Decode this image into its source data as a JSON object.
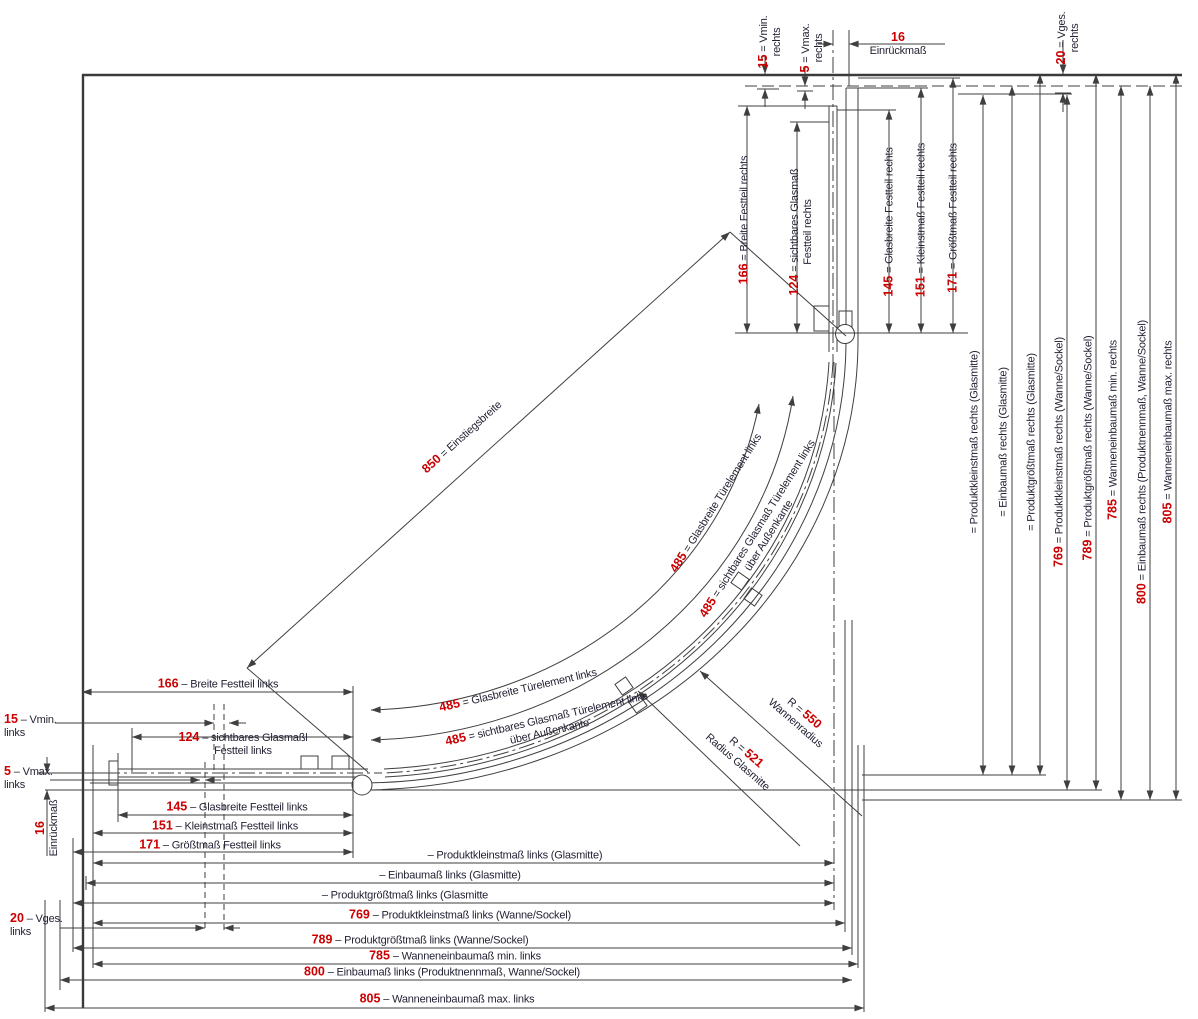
{
  "colors": {
    "dimension_number": "#cc0000",
    "label_text": "#232335",
    "line": "#3f3f3f",
    "background": "#ffffff"
  },
  "drawing_type": "Maßzeichnung Runddusche (Draufsicht)",
  "dimensions": [
    {
      "name": "dim-vmin-rechts",
      "num": "15",
      "text": "= Vmin.",
      "text2": "rechts",
      "x": 770,
      "y": 42,
      "rot": -90
    },
    {
      "name": "dim-vmax-rechts",
      "num": "5",
      "text": "= Vmax.",
      "text2": "rechts",
      "x": 812,
      "y": 48,
      "rot": -90
    },
    {
      "name": "dim-einrueckmass-rechts",
      "num": "16",
      "text": "",
      "text2": "Einrückmaß",
      "x": 898,
      "y": 44,
      "rot": 0
    },
    {
      "name": "dim-vges-rechts",
      "num": "20",
      "text": "= Vges.",
      "text2": "rechts",
      "x": 1068,
      "y": 38,
      "rot": -90
    },
    {
      "name": "dim-breite-festteil-rechts",
      "num": "166",
      "text": "= Breite Festteil rechts",
      "text2": "",
      "x": 744,
      "y": 220,
      "rot": -90
    },
    {
      "name": "dim-sichtbares-glasmass-festteil-rechts",
      "num": "124",
      "text": "= sichtbares Glasmaß",
      "text2": "Festteil rechts",
      "x": 801,
      "y": 232,
      "rot": -90
    },
    {
      "name": "dim-glasbreite-festteil-rechts",
      "num": "145",
      "text": "= Glasbreite Festteil rechts",
      "text2": "",
      "x": 889,
      "y": 222,
      "rot": -90
    },
    {
      "name": "dim-kleinstmass-festteil-rechts",
      "num": "151",
      "text": "= Kleinstmaß Festteil rechts",
      "text2": "",
      "x": 921,
      "y": 220,
      "rot": -90
    },
    {
      "name": "dim-groesstmass-festteil-rechts",
      "num": "171",
      "text": "= Größtmaß Festteil rechts",
      "text2": "",
      "x": 953,
      "y": 218,
      "rot": -90
    },
    {
      "name": "dim-produktkleinstmass-rechts-glasmitte",
      "num": "",
      "text": "= Produktkleinstmaß rechts (Glasmitte)",
      "text2": "",
      "x": 975,
      "y": 442,
      "rot": -90
    },
    {
      "name": "dim-einbaumass-rechts-glasmitte",
      "num": "",
      "text": "= Einbaumaß rechts (Glasmitte)",
      "text2": "",
      "x": 1004,
      "y": 442,
      "rot": -90
    },
    {
      "name": "dim-produktgroesstmass-rechts-glasmitte",
      "num": "",
      "text": "= Produktgrößtmaß rechts (Glasmitte)",
      "text2": "",
      "x": 1032,
      "y": 442,
      "rot": -90
    },
    {
      "name": "dim-produktkleinstmass-rechts-wanne",
      "num": "769",
      "text": "= Produktkleinstmaß rechts (Wanne/Sockel)",
      "text2": "",
      "x": 1059,
      "y": 452,
      "rot": -90
    },
    {
      "name": "dim-produktgroesstmass-rechts-wanne",
      "num": "789",
      "text": "= Produktgrößtmaß rechts (Wanne/Sockel)",
      "text2": "",
      "x": 1088,
      "y": 448,
      "rot": -90
    },
    {
      "name": "dim-wanneneinbaumass-min-rechts",
      "num": "785",
      "text": "= Wanneneinbaumaß min. rechts",
      "text2": "",
      "x": 1113,
      "y": 430,
      "rot": -90
    },
    {
      "name": "dim-einbaumass-rechts-produktnennmass",
      "num": "800",
      "text": "= Einbaumaß rechts (Produktnennmaß, Wanne/Sockel)",
      "text2": "",
      "x": 1142,
      "y": 462,
      "rot": -90
    },
    {
      "name": "dim-wanneneinbaumass-max-rechts",
      "num": "805",
      "text": "= Wanneneinbaumaß max. rechts",
      "text2": "",
      "x": 1168,
      "y": 432,
      "rot": -90
    },
    {
      "name": "dim-einstiegsbreite",
      "num": "850",
      "text": "= Einstiegsbreite",
      "text2": "",
      "x": 462,
      "y": 437,
      "rot": -42
    },
    {
      "name": "dim-glasbreite-tuerelement-links-oben",
      "num": "485",
      "text": "= Glasbreite Türelement links",
      "text2": "",
      "x": 716,
      "y": 503,
      "rot": -58
    },
    {
      "name": "dim-sichtbares-glasmass-tuerelement-links-oben",
      "num": "485",
      "text": "= sichtbares Glasmaß Türelement links",
      "text2": "über Außenkante",
      "x": 763,
      "y": 532,
      "rot": -58
    },
    {
      "name": "dim-glasbreite-tuerelement-links-unten",
      "num": "485",
      "text": "= Glasbreite Türelement links",
      "text2": "",
      "x": 518,
      "y": 690,
      "rot": -13
    },
    {
      "name": "dim-sichtbares-glasmass-tuerelement-links-unten",
      "num": "485",
      "text": "= sichtbares Glasmaß Türelement links",
      "text2": "über Außenkante",
      "x": 548,
      "y": 725,
      "rot": -13
    },
    {
      "name": "dim-wannenradius",
      "pre": "R =",
      "num": "550",
      "text": "",
      "text2": "Wannenradius",
      "x": 800,
      "y": 718,
      "rot": 41
    },
    {
      "name": "dim-radius-glasmitte",
      "pre": "R =",
      "num": "521",
      "text": "",
      "text2": "Radius Glasmitte",
      "x": 742,
      "y": 757,
      "rot": 41
    },
    {
      "name": "dim-breite-festteil-links",
      "num": "166",
      "text": "– Breite Festteil links",
      "text2": "",
      "x": 218,
      "y": 684,
      "rot": 0
    },
    {
      "name": "dim-vmin-links",
      "num": "15",
      "text": "– Vmin.",
      "text2": "links",
      "x": 4,
      "y": 726,
      "rot": 0,
      "align": "left"
    },
    {
      "name": "dim-sichtbares-glasmass-festteil-links",
      "num": "124",
      "text": "– sichtbares Glasmaßl",
      "text2": "Festteil links",
      "x": 243,
      "y": 744,
      "rot": 0
    },
    {
      "name": "dim-vmax-links",
      "num": "5",
      "text": "– Vmax.",
      "text2": "links",
      "x": 4,
      "y": 778,
      "rot": 0,
      "align": "left"
    },
    {
      "name": "dim-glasbreite-festteil-links",
      "num": "145",
      "text": "– Glasbreite Festteil links",
      "text2": "",
      "x": 237,
      "y": 807,
      "rot": 0
    },
    {
      "name": "dim-kleinstmass-festteil-links",
      "num": "151",
      "text": "– Kleinstmaß Festteil links",
      "text2": "",
      "x": 225,
      "y": 826,
      "rot": 0
    },
    {
      "name": "dim-groesstmass-festteil-links",
      "num": "171",
      "text": "– Größtmaß Festteil links",
      "text2": "",
      "x": 210,
      "y": 845,
      "rot": 0
    },
    {
      "name": "dim-einrueckmass-links",
      "num": "16",
      "text": "",
      "text2": "Einrückmaß",
      "x": 47,
      "y": 828,
      "rot": -90
    },
    {
      "name": "dim-vges-links",
      "num": "20",
      "text": "– Vges.",
      "text2": "links",
      "x": 10,
      "y": 925,
      "rot": 0,
      "align": "left"
    },
    {
      "name": "dim-produktkleinstmass-links-glasmitte",
      "num": "",
      "text": "– Produktkleinstmaß links (Glasmitte)",
      "text2": "",
      "x": 515,
      "y": 856,
      "rot": 0
    },
    {
      "name": "dim-einbaumass-links-glasmitte",
      "num": "",
      "text": "– Einbaumaß links (Glasmitte)",
      "text2": "",
      "x": 450,
      "y": 876,
      "rot": 0
    },
    {
      "name": "dim-produktgroesstmass-links-glasmitte",
      "num": "",
      "text": "– Produktgrößtmaß links (Glasmitte",
      "text2": "",
      "x": 405,
      "y": 896,
      "rot": 0
    },
    {
      "name": "dim-produktkleinstmass-links-wanne",
      "num": "769",
      "text": "– Produktkleinstmaß links (Wanne/Sockel)",
      "text2": "",
      "x": 460,
      "y": 915,
      "rot": 0
    },
    {
      "name": "dim-produktgroesstmass-links-wanne",
      "num": "789",
      "text": "– Produktgrößtmaß links (Wanne/Sockel)",
      "text2": "",
      "x": 420,
      "y": 940,
      "rot": 0
    },
    {
      "name": "dim-wanneneinbaumass-min-links",
      "num": "785",
      "text": "– Wanneneinbaumaß min. links",
      "text2": "",
      "x": 455,
      "y": 956,
      "rot": 0
    },
    {
      "name": "dim-einbaumass-links-produktnennmass",
      "num": "800",
      "text": "– Einbaumaß links (Produktnennmaß, Wanne/Sockel)",
      "text2": "",
      "x": 442,
      "y": 972,
      "rot": 0
    },
    {
      "name": "dim-wanneneinbaumass-max-links",
      "num": "805",
      "text": "– Wanneneinbaumaß max. links",
      "text2": "",
      "x": 447,
      "y": 999,
      "rot": 0
    }
  ]
}
